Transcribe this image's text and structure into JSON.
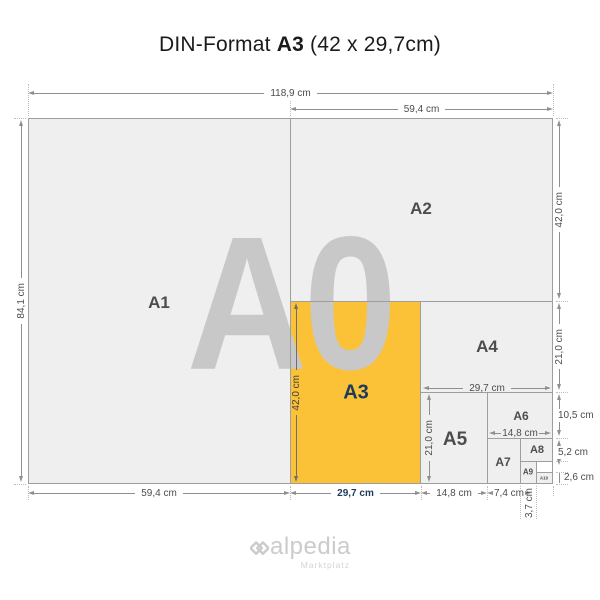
{
  "title": {
    "prefix": "DIN-Format",
    "format": "A3",
    "suffix": "(42 x 29,7cm)"
  },
  "watermark": "A0",
  "papers": [
    {
      "label": "A1"
    },
    {
      "label": "A2"
    },
    {
      "label": "A3"
    },
    {
      "label": "A4"
    },
    {
      "label": "A5"
    },
    {
      "label": "A6"
    },
    {
      "label": "A7"
    },
    {
      "label": "A8"
    },
    {
      "label": "A9"
    },
    {
      "label": "A10"
    }
  ],
  "dims": {
    "total_width": "118,9 cm",
    "half_width": "59,4 cm",
    "total_height": "84,1 cm",
    "a2_height": "42,0 cm",
    "a4_height": "21,0 cm",
    "a6_height": "10,5 cm",
    "a8_height": "5,2 cm",
    "a10_height": "2,6 cm",
    "a1_width": "59,4 cm",
    "a3_width": "29,7 cm",
    "a5_width": "14,8 cm",
    "a7_width": "7,4 cm",
    "a9_width": "3,7 cm",
    "a3_height": "42,0 cm",
    "a4_width": "29,7 cm",
    "a5_height": "21,0 cm",
    "a6_width": "14,8 cm"
  },
  "logo": {
    "name": "alpedia",
    "subtitle": "Marktplatz"
  },
  "colors": {
    "accent_orange": "#FBC137",
    "label_navy": "#1D3A5C",
    "paper_gray": "#EFEFEF",
    "border_gray": "#9E9E9E",
    "watermark_gray": "#C8C8C8"
  }
}
